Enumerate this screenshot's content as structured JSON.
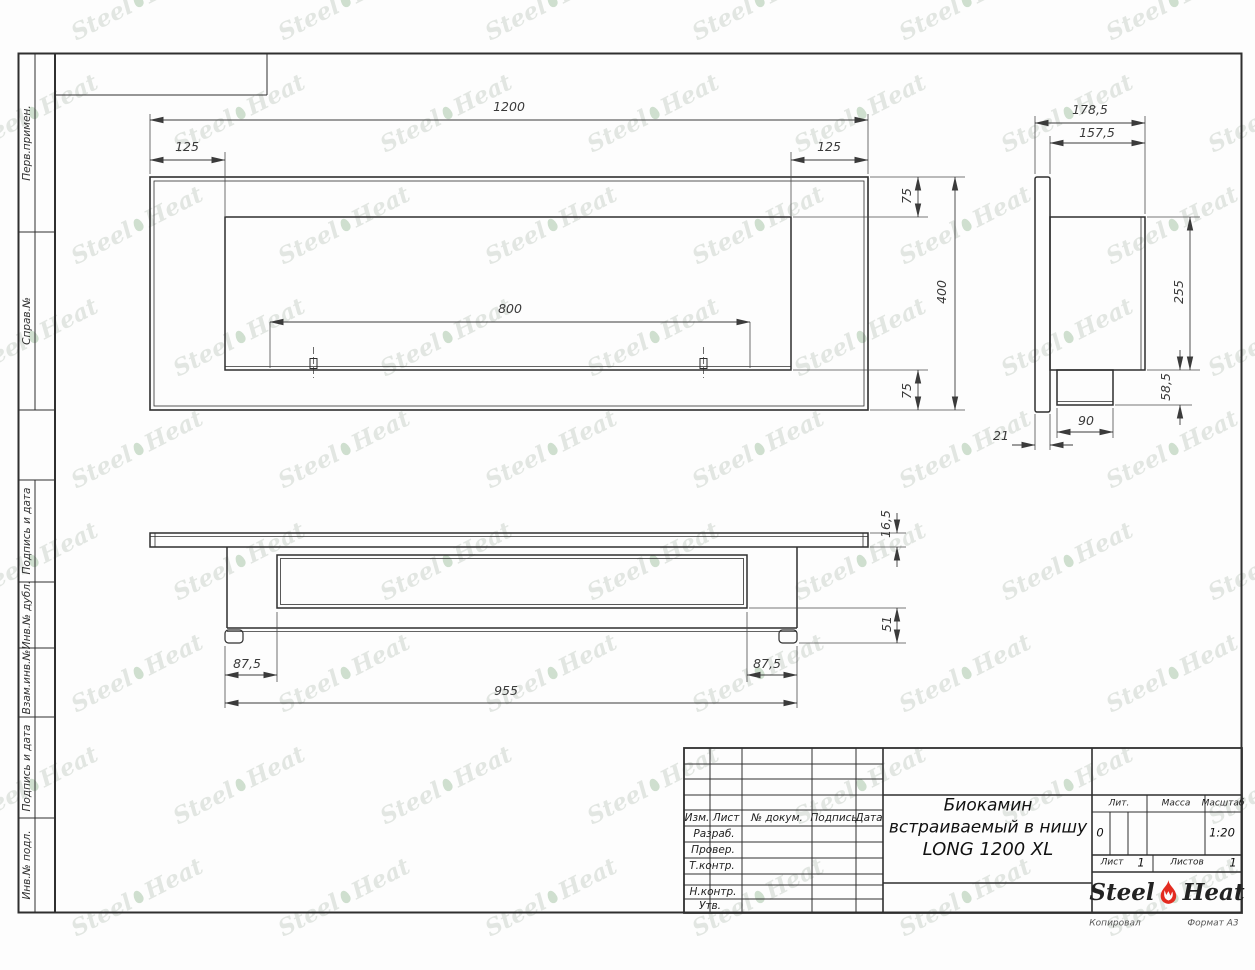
{
  "document": {
    "title_line1": "Биокамин",
    "title_line2": "встраиваемый в нишу",
    "title_line3": "LONG 1200 XL",
    "litera": "0",
    "scale": "1:20",
    "sheet_no": "1",
    "sheets_total": "1",
    "copied": "Копировал",
    "format": "Формат А3"
  },
  "brand": {
    "left": "Steel",
    "right": "Heat"
  },
  "title_block": {
    "izm": "Изм.",
    "list": "Лист",
    "doc": "№ докум.",
    "podpis": "Подпись",
    "data": "Дата",
    "razrab": "Разраб.",
    "prover": "Провер.",
    "tkontr": "Т.контр.",
    "nkontr": "Н.контр.",
    "utv": "Утв.",
    "lit": "Лит.",
    "massa": "Масса",
    "masshtab": "Масштаб",
    "list2": "Лист",
    "listov": "Листов"
  },
  "margin_labels": {
    "perv": "Перв.примен.",
    "sprav": "Справ.№",
    "podpis1": "Подпись и дата",
    "inv_dubl": "Инв.№ дубл.",
    "vzam": "Взам.инв.№",
    "podpis2": "Подпись и дата",
    "inv_podl": "Инв.№ подл."
  },
  "dimensions": {
    "front": {
      "width": "1200",
      "inset_left": "125",
      "inset_right": "125",
      "burner": "800",
      "top_margin": "75",
      "height": "400",
      "bottom_margin": "75"
    },
    "side": {
      "depth_total": "178,5",
      "depth_body": "157,5",
      "body_height": "255",
      "tray_depth": "58,5",
      "tray_width": "90",
      "flange": "21"
    },
    "bottom": {
      "flange_thickness": "16,5",
      "foot_height": "51",
      "offset_left": "87,5",
      "offset_right": "87,5",
      "body_width": "955"
    }
  }
}
